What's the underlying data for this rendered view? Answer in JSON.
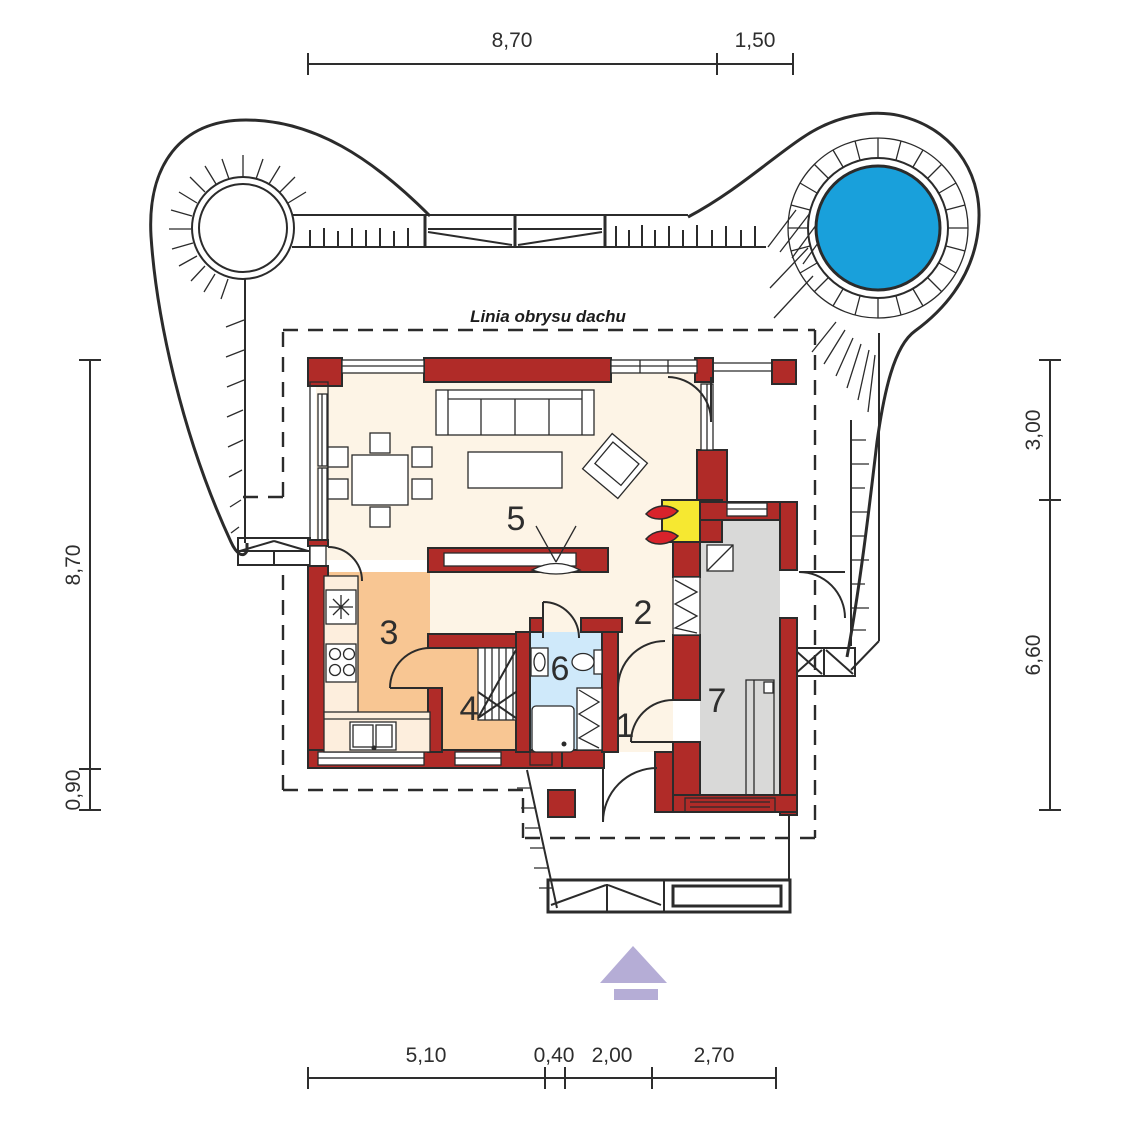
{
  "site": {
    "roof_outline_label": "Linia obrysu dachu"
  },
  "rooms": [
    {
      "label": "1"
    },
    {
      "label": "2"
    },
    {
      "label": "3"
    },
    {
      "label": "4"
    },
    {
      "label": "5"
    },
    {
      "label": "6"
    },
    {
      "label": "7"
    }
  ],
  "dimensions": {
    "top": [
      {
        "label": "8,70"
      },
      {
        "label": "1,50"
      }
    ],
    "bottom": [
      {
        "label": "5,10"
      },
      {
        "label": "0,40"
      },
      {
        "label": "2,00"
      },
      {
        "label": "2,70"
      }
    ],
    "left": [
      {
        "label": "8,70"
      },
      {
        "label": "0,90"
      }
    ],
    "right": [
      {
        "label": "3,00"
      },
      {
        "label": "6,60"
      }
    ]
  },
  "colors": {
    "wall": "#b02b28",
    "floor": "#fdf4e6",
    "kitchen": "#f8c693",
    "kitchen_counter": "#fdeedd",
    "bath": "#cfe9fa",
    "garage": "#d9d9d8",
    "pool": "#19a0db",
    "fireplace": "#f6e831",
    "flame": "#d8232b",
    "arrow": "#b5add6",
    "line": "#2b2b2b",
    "dimension_text": "#2e2e2e"
  }
}
